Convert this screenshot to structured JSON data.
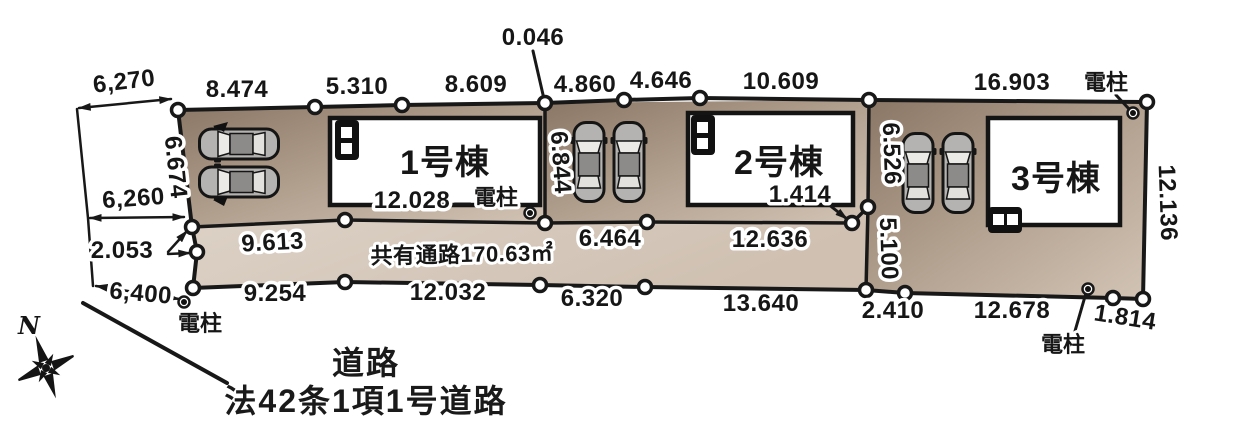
{
  "site": {
    "buildings": [
      {
        "label": "1号棟"
      },
      {
        "label": "2号棟"
      },
      {
        "label": "3号棟"
      }
    ],
    "passage_label": "共有通路170.63㎡",
    "road": {
      "name": "道路",
      "classification": "法42条1項1号道路"
    },
    "compass": {
      "north": "N"
    },
    "utility_pole_label": "電柱",
    "dims": {
      "west_chain": [
        "6,270",
        "6.674",
        "6,260",
        "2.053",
        "6,400"
      ],
      "top_edge": [
        "8.474",
        "5.310",
        "8.609",
        "0.046",
        "4.860",
        "4.646",
        "10.609",
        "16.903"
      ],
      "right_edge": [
        "12.136"
      ],
      "bottom_edge": [
        "9.254",
        "12.032",
        "6.320",
        "13.640",
        "2.410",
        "12.678",
        "1.814"
      ],
      "inner": [
        "9.613",
        "12.028",
        "6.464",
        "12.636",
        "1.414"
      ],
      "cross": [
        "6.844",
        "6.526",
        "5.100"
      ]
    },
    "colors": {
      "lot_dark": "#8a7665",
      "lot_mid": "#b2a08f",
      "lot_light": "#d2c4b5",
      "passage_light": "#ddd2c7",
      "passage_mid": "#cfc0b1",
      "line": "#181818"
    }
  }
}
